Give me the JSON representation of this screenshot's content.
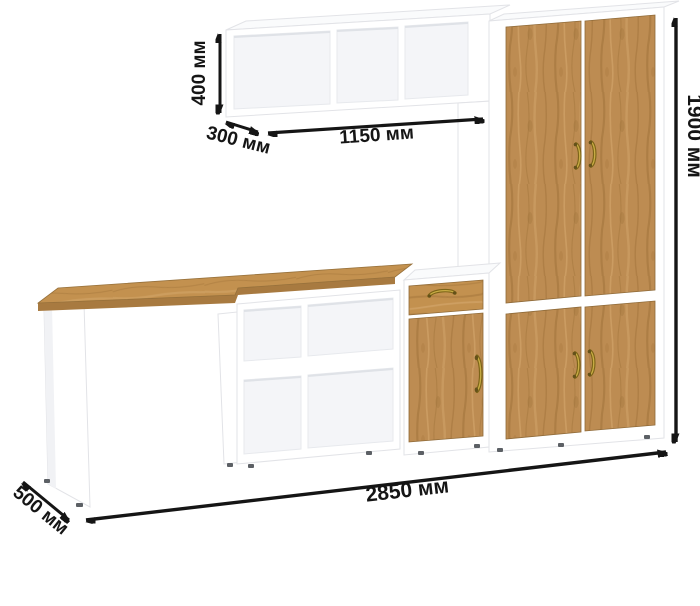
{
  "dimensions": {
    "shelf_height": "400 мм",
    "shelf_depth": "300 мм",
    "shelf_width": "1150 мм",
    "total_height": "1900 мм",
    "total_width": "2850 мм",
    "desk_depth": "500 мм"
  },
  "parts": {
    "wall_shelf": "wall shelf with 3 open compartments",
    "wardrobe": "tall two-section wardrobe with wooden doors",
    "desk": "desk with wooden top",
    "cube_shelf": "open shelf unit 2x2",
    "cabinet": "small cabinet with drawer and door"
  },
  "colors": {
    "background": "#ffffff",
    "outline": "#e2e3e7",
    "wood": "#bd8c52",
    "wood-desktop": "#c3914f",
    "wood-dark": "#9e7038",
    "wood-light": "#d6a96e",
    "wood-edge": "#a87a40",
    "annotation": "#151515",
    "handle": "#7c6418",
    "handle-light": "#c9ad45"
  }
}
